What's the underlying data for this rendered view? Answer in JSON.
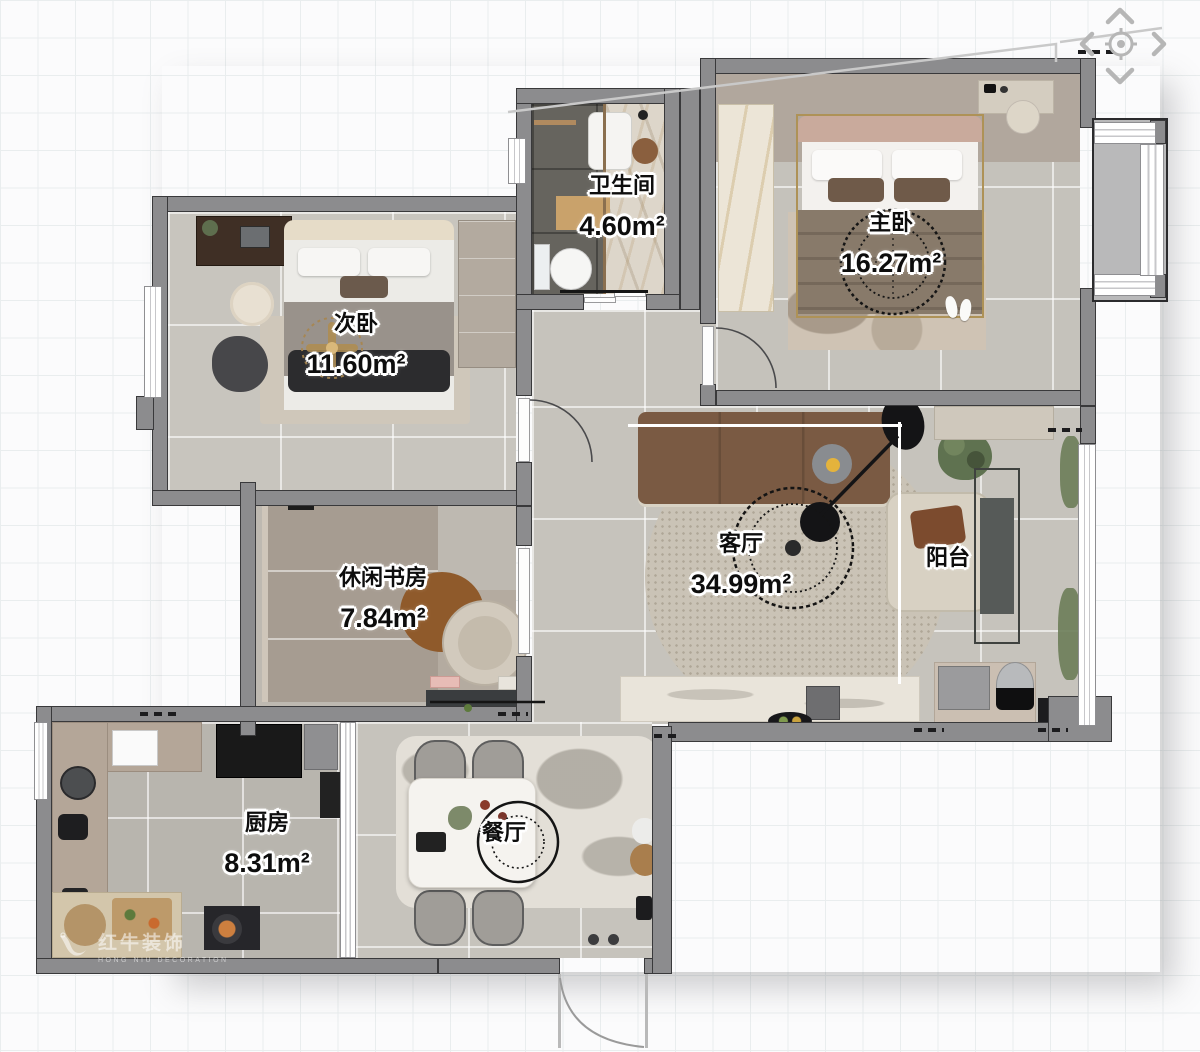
{
  "plan_title": "apartment-floor-plan",
  "rooms": [
    {
      "id": "secondary-bedroom",
      "name": "次卧",
      "area": "11.60m²"
    },
    {
      "id": "bathroom",
      "name": "卫生间",
      "area": "4.60m²"
    },
    {
      "id": "master-bedroom",
      "name": "主卧",
      "area": "16.27m²"
    },
    {
      "id": "study",
      "name": "休闲书房",
      "area": "7.84m²"
    },
    {
      "id": "living-room",
      "name": "客厅",
      "area": "34.99m²"
    },
    {
      "id": "balcony",
      "name": "阳台",
      "area": ""
    },
    {
      "id": "kitchen",
      "name": "厨房",
      "area": "8.31m²"
    },
    {
      "id": "dining-room",
      "name": "餐厅",
      "area": ""
    }
  ],
  "nav": {
    "controls": [
      {
        "id": "pan-up",
        "icon": "chevron-up-icon"
      },
      {
        "id": "pan-left",
        "icon": "chevron-left-icon"
      },
      {
        "id": "reset-view",
        "icon": "target-icon"
      },
      {
        "id": "pan-right",
        "icon": "chevron-right-icon"
      },
      {
        "id": "pan-down",
        "icon": "chevron-down-icon"
      }
    ]
  },
  "watermark": {
    "brand": "红牛装饰",
    "subtitle": "HONG NIU DECORATION",
    "icon": "bull-logo-icon"
  },
  "colors": {
    "wall": "#8c8c8e",
    "wall_edge": "#39393b",
    "floor_light": "#c6c3bc",
    "floor_dark": "#66645e",
    "accent_tan": "#c9a26b",
    "sofa_brown": "#7a5a43",
    "label_text": "#0d0d0d",
    "label_halo": "#ffffff",
    "grid_line": "#e9edee",
    "nav_icon": "#b6b6b6",
    "gold": "#ae9257"
  }
}
